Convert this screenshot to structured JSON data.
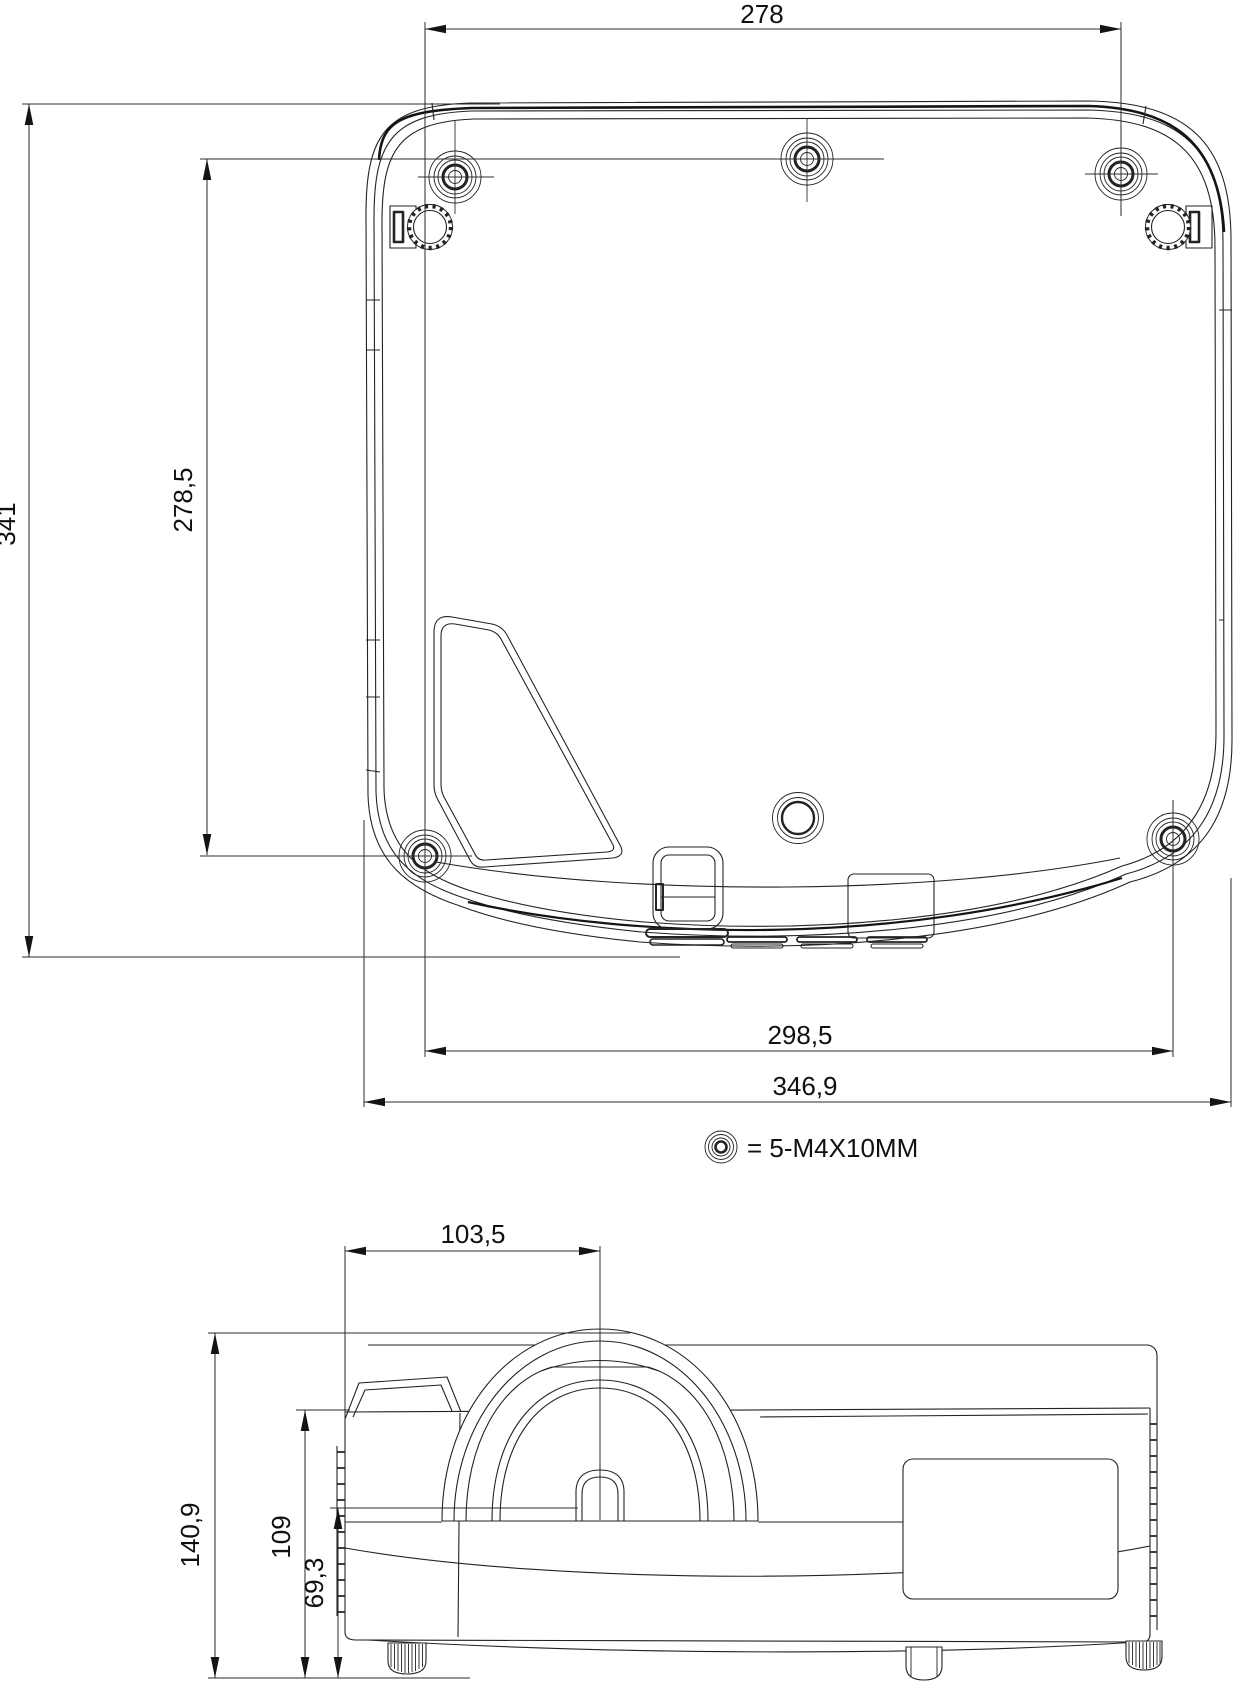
{
  "palette": {
    "background": "#ffffff",
    "line": "#232323",
    "text": "#101010"
  },
  "views": {
    "bottom_view": {
      "name": "projector-bottom-view",
      "dimensions": {
        "width_top": "278",
        "height_left": "341",
        "height_inner": "278,5",
        "width_bottom_inner": "298,5",
        "width_bottom_outer": "346,9"
      },
      "legend": {
        "symbol": "screw-hole-symbol",
        "text": "= 5-M4X10MM"
      }
    },
    "rear_view": {
      "name": "projector-rear-view",
      "dimensions": {
        "lens_offset": "103,5",
        "height_total": "140,9",
        "height_body": "109",
        "lens_center_height": "69,3"
      }
    }
  }
}
